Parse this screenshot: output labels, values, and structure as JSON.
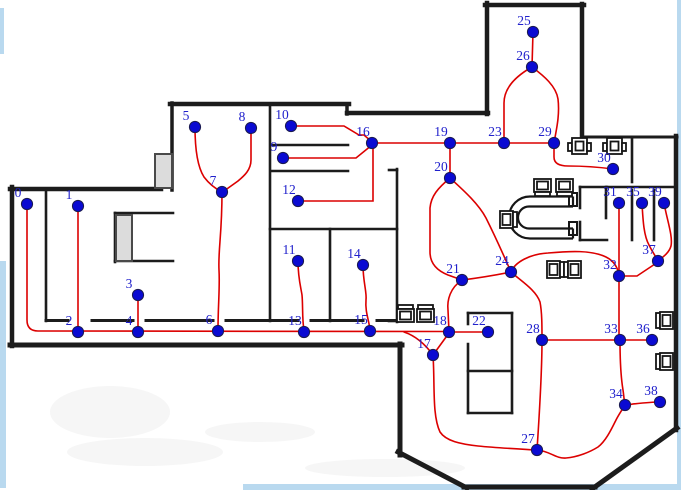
{
  "canvas": {
    "width": 681,
    "height": 490,
    "background": "#ffffff"
  },
  "colors": {
    "wall": "#1c1c1c",
    "edge": "#dc0000",
    "node_fill": "#0a0ad2",
    "node_stroke": "#1a1a50",
    "label": "#2020cc",
    "door_fill": "#dcdcdc",
    "door_stroke": "#4a4a4a",
    "furniture": "#161616",
    "frame": "#b9d9ef",
    "smudge": "rgba(125,125,125,0.07)"
  },
  "frame_strips": [
    {
      "x": 677,
      "y": 0,
      "w": 4,
      "h": 490
    },
    {
      "x": 243,
      "y": 484,
      "w": 438,
      "h": 6
    },
    {
      "x": 0,
      "y": 261,
      "w": 6,
      "h": 227
    },
    {
      "x": 0,
      "y": 8,
      "w": 4,
      "h": 46
    }
  ],
  "smudges": [
    {
      "cx": 145,
      "cy": 452,
      "rx": 78,
      "ry": 14
    },
    {
      "cx": 385,
      "cy": 468,
      "rx": 80,
      "ry": 9
    },
    {
      "cx": 260,
      "cy": 432,
      "rx": 55,
      "ry": 10
    },
    {
      "cx": 110,
      "cy": 412,
      "rx": 60,
      "ry": 26
    }
  ],
  "walls_outer": [
    [
      12,
      346,
      12,
      187,
      4.5
    ],
    [
      10,
      189,
      161,
      189,
      4.5
    ],
    [
      172,
      190,
      172,
      103,
      3.5
    ],
    [
      170,
      104,
      349,
      104,
      4.5
    ],
    [
      347,
      104,
      347,
      114,
      3.5
    ],
    [
      347,
      113,
      488,
      113,
      4.5
    ],
    [
      487,
      114,
      487,
      3,
      4.5
    ],
    [
      485,
      5,
      584,
      5,
      4.5
    ],
    [
      582,
      4,
      582,
      139,
      4.5
    ],
    [
      583,
      137,
      677,
      137,
      3
    ],
    [
      676,
      136,
      676,
      430,
      4.5
    ],
    [
      677,
      428,
      592,
      489,
      5
    ],
    [
      595,
      487,
      464,
      487,
      5
    ],
    [
      467,
      488,
      398,
      452,
      5
    ],
    [
      400,
      455,
      400,
      344,
      5
    ],
    [
      10,
      345,
      402,
      345,
      5
    ]
  ],
  "walls_inner": [
    [
      46,
      189,
      46,
      321,
      2.6
    ],
    [
      270,
      104,
      270,
      321,
      2.6
    ],
    [
      272,
      145,
      348,
      145,
      2.6
    ],
    [
      272,
      171,
      348,
      171,
      2.6
    ],
    [
      270,
      229,
      397,
      229,
      2.6
    ],
    [
      330,
      229,
      330,
      321,
      2.6
    ],
    [
      397,
      169,
      397,
      322,
      2.6
    ],
    [
      389,
      170,
      397,
      170,
      2.6
    ],
    [
      389,
      321,
      397,
      321,
      2.6
    ],
    [
      115,
      213,
      115,
      262,
      2.6
    ],
    [
      115,
      213,
      173,
      213,
      2.6
    ],
    [
      115,
      261,
      173,
      261,
      2.6
    ],
    [
      46,
      320.5,
      68,
      320.5,
      3
    ],
    [
      92,
      320.5,
      133,
      320.5,
      3
    ],
    [
      146,
      320.5,
      213,
      320.5,
      3
    ],
    [
      226,
      320.5,
      298,
      320.5,
      3
    ],
    [
      311,
      320.5,
      363,
      320.5,
      3
    ],
    [
      377,
      320.5,
      397,
      320.5,
      3
    ],
    [
      580,
      187,
      607,
      187,
      2.6
    ],
    [
      580,
      240,
      607,
      240,
      2.6
    ],
    [
      580,
      187,
      580,
      208,
      2.6
    ],
    [
      580,
      222,
      580,
      240,
      2.6
    ],
    [
      606,
      187,
      606,
      218,
      2.6
    ],
    [
      607,
      187,
      676,
      187,
      2.6
    ],
    [
      632,
      137,
      632,
      182,
      2.6
    ],
    [
      632,
      190,
      632,
      240,
      2.6
    ],
    [
      654,
      190,
      654,
      240,
      2.6
    ],
    [
      468,
      313,
      512,
      313,
      2.6
    ],
    [
      512,
      313,
      512,
      413,
      2.6
    ],
    [
      468,
      413,
      512,
      413,
      2.6
    ],
    [
      468,
      313,
      468,
      324,
      2.6
    ],
    [
      468,
      344,
      468,
      413,
      2.6
    ],
    [
      468,
      371,
      512,
      371,
      2.6
    ]
  ],
  "doors": [
    {
      "x": 155,
      "y": 154,
      "w": 17,
      "h": 34
    },
    {
      "x": 116,
      "y": 215,
      "w": 16,
      "h": 46
    }
  ],
  "stubs": [
    {
      "x": 569,
      "y": 193,
      "w": 8,
      "h": 13
    },
    {
      "x": 569,
      "y": 222,
      "w": 8,
      "h": 13
    }
  ],
  "utable": {
    "outer": "M573,196.5 H530 A21,21 0 0 0 530,238.5 H573",
    "inner": "M573,206.5 H529 A11,11 0 0 0 529,228.5 H573",
    "caps": "M573,196.5 V206.5 M573,228.5 V238.5"
  },
  "furniture": [
    {
      "type": "chair",
      "x": 534,
      "y": 179,
      "facing": "down"
    },
    {
      "type": "chair",
      "x": 556,
      "y": 179,
      "facing": "down"
    },
    {
      "type": "chair",
      "x": 500,
      "y": 211,
      "facing": "right"
    },
    {
      "type": "chair",
      "x": 547,
      "y": 261,
      "facing": "right"
    },
    {
      "type": "chair",
      "x": 564,
      "y": 261,
      "facing": "left"
    },
    {
      "type": "chair",
      "x": 397,
      "y": 305,
      "facing": "up"
    },
    {
      "type": "chair",
      "x": 417,
      "y": 305,
      "facing": "up"
    },
    {
      "type": "door-tab",
      "x": 568,
      "y": 138
    },
    {
      "type": "door-tab",
      "x": 603,
      "y": 138
    },
    {
      "type": "chair",
      "x": 656,
      "y": 312,
      "facing": "left"
    },
    {
      "type": "chair",
      "x": 656,
      "y": 353,
      "facing": "left"
    }
  ],
  "edges": [
    {
      "name": "edge-0-2-4-6-13-15-18",
      "d": "M27,204 V320 Q27,331 38,331 L449,331.5"
    },
    {
      "name": "edge-1-2",
      "d": "M78,206 V331"
    },
    {
      "name": "edge-3-4",
      "d": "M138,295 V331"
    },
    {
      "name": "edge-5-7",
      "d": "M195,127 C195,148 197,166 204,177 C210,185 216,189 222,192"
    },
    {
      "name": "edge-8-7",
      "d": "M251,128 V160 C251,170 244,176 238,181 L224,191"
    },
    {
      "name": "edge-7-6",
      "d": "M222,192 C222,235 218,250 219,270 C220,288 218,305 218,330"
    },
    {
      "name": "edge-10-16",
      "d": "M291,126 H344 L359,135 H364 L372,142"
    },
    {
      "name": "edge-9-16",
      "d": "M283,158 H356 L372,145"
    },
    {
      "name": "edge-12-16",
      "d": "M298,201 H373 V146"
    },
    {
      "name": "edge-16-19",
      "d": "M372,143 H450"
    },
    {
      "name": "edge-19-23",
      "d": "M450,143 H504"
    },
    {
      "name": "edge-23-29",
      "d": "M504,143 H554"
    },
    {
      "name": "edge-19-20",
      "d": "M450,143 V178"
    },
    {
      "name": "edge-25-26",
      "d": "M533,32 L532,67"
    },
    {
      "name": "edge-23-26",
      "d": "M504,143 V103 C504,88 516,76 532,67"
    },
    {
      "name": "edge-26-29",
      "d": "M532,67 C544,76 556,86 558,99 C560,116 556,131 554,143"
    },
    {
      "name": "edge-29-30",
      "d": "M554,143 V157 C554,164 560,166 568,166 C583,166 598,167 613,169"
    },
    {
      "name": "edge-20-21",
      "d": "M450,178 C438,188 431,196 430,208 V252 C430,264 438,271 448,275 L462,280"
    },
    {
      "name": "edge-20-24",
      "d": "M450,178 C462,189 478,203 486,218 C494,234 504,256 511,272"
    },
    {
      "name": "edge-21-24",
      "d": "M462,280 C478,278 496,275 511,272"
    },
    {
      "name": "edge-21-18",
      "d": "M462,280 C450,288 447,300 448,310 L449,332"
    },
    {
      "name": "edge-17-15",
      "d": "M433,355 C425,344 416,336 404,332"
    },
    {
      "name": "edge-17-18",
      "d": "M433,355 L449,333"
    },
    {
      "name": "edge-18-22",
      "d": "M449,332 H488"
    },
    {
      "name": "edge-11-13",
      "d": "M298,261 C298,278 301,288 302,295 C303,305 302,318 304,331"
    },
    {
      "name": "edge-14-15",
      "d": "M363,265 C363,282 367,292 366,300 C365,312 369,320 370,330"
    },
    {
      "name": "edge-24-28",
      "d": "M511,272 C521,281 536,290 540,302 C542,312 542,326 542,340"
    },
    {
      "name": "edge-24-32",
      "d": "M511,272 C515,262 530,254 548,253 C570,251 592,250 606,257 C614,261 618,267 619,276"
    },
    {
      "name": "edge-28-27",
      "d": "M542,340 C542,375 539,420 537,450"
    },
    {
      "name": "edge-28-33",
      "d": "M542,340 H620"
    },
    {
      "name": "edge-33-36",
      "d": "M620,340 H652"
    },
    {
      "name": "edge-31-32",
      "d": "M619,203 V276"
    },
    {
      "name": "edge-32-33",
      "d": "M619,276 V340"
    },
    {
      "name": "edge-32-37",
      "d": "M619,276 H637 L658,262"
    },
    {
      "name": "edge-35-37",
      "d": "M642,203 C643,222 644,236 649,245 C652,251 655,256 658,260"
    },
    {
      "name": "edge-39-37",
      "d": "M664,203 C667,220 673,236 671,246 C669,253 663,257 659,260"
    },
    {
      "name": "edge-33-34",
      "d": "M620,340 C620,362 621,378 623,390 C624,397 624,400 625,405"
    },
    {
      "name": "edge-34-38",
      "d": "M625,405 C634,404 648,402 660,402"
    },
    {
      "name": "edge-17-27-34",
      "d": "M433,355 C435,385 432,415 440,432 C446,441 460,444 478,446 C498,448 520,449 537,450 C550,451 556,459 566,458 C578,457 590,452 598,447 C606,441 612,428 616,420 C619,414 622,410 625,405"
    }
  ],
  "nodes": [
    {
      "label": "0",
      "x": 27,
      "y": 204
    },
    {
      "label": "1",
      "x": 78,
      "y": 206
    },
    {
      "label": "2",
      "x": 78,
      "y": 332
    },
    {
      "label": "3",
      "x": 138,
      "y": 295
    },
    {
      "label": "4",
      "x": 138,
      "y": 332
    },
    {
      "label": "5",
      "x": 195,
      "y": 127
    },
    {
      "label": "6",
      "x": 218,
      "y": 331
    },
    {
      "label": "7",
      "x": 222,
      "y": 192
    },
    {
      "label": "8",
      "x": 251,
      "y": 128
    },
    {
      "label": "9",
      "x": 283,
      "y": 158
    },
    {
      "label": "10",
      "x": 291,
      "y": 126
    },
    {
      "label": "11",
      "x": 298,
      "y": 261
    },
    {
      "label": "12",
      "x": 298,
      "y": 201
    },
    {
      "label": "13",
      "x": 304,
      "y": 332
    },
    {
      "label": "14",
      "x": 363,
      "y": 265
    },
    {
      "label": "15",
      "x": 370,
      "y": 331
    },
    {
      "label": "16",
      "x": 372,
      "y": 143
    },
    {
      "label": "17",
      "x": 433,
      "y": 355
    },
    {
      "label": "18",
      "x": 449,
      "y": 332
    },
    {
      "label": "19",
      "x": 450,
      "y": 143
    },
    {
      "label": "20",
      "x": 450,
      "y": 178
    },
    {
      "label": "21",
      "x": 462,
      "y": 280
    },
    {
      "label": "22",
      "x": 488,
      "y": 332
    },
    {
      "label": "23",
      "x": 504,
      "y": 143
    },
    {
      "label": "24",
      "x": 511,
      "y": 272
    },
    {
      "label": "25",
      "x": 533,
      "y": 32
    },
    {
      "label": "26",
      "x": 532,
      "y": 67
    },
    {
      "label": "27",
      "x": 537,
      "y": 450
    },
    {
      "label": "28",
      "x": 542,
      "y": 340
    },
    {
      "label": "29",
      "x": 554,
      "y": 143
    },
    {
      "label": "30",
      "x": 613,
      "y": 169
    },
    {
      "label": "31",
      "x": 619,
      "y": 203
    },
    {
      "label": "32",
      "x": 619,
      "y": 276
    },
    {
      "label": "33",
      "x": 620,
      "y": 340
    },
    {
      "label": "34",
      "x": 625,
      "y": 405
    },
    {
      "label": "35",
      "x": 642,
      "y": 203
    },
    {
      "label": "36",
      "x": 652,
      "y": 340
    },
    {
      "label": "37",
      "x": 658,
      "y": 261
    },
    {
      "label": "38",
      "x": 660,
      "y": 402
    },
    {
      "label": "39",
      "x": 664,
      "y": 203
    }
  ],
  "node_radius": 5.6,
  "label_offset": {
    "dx": -9,
    "dy": -7
  }
}
